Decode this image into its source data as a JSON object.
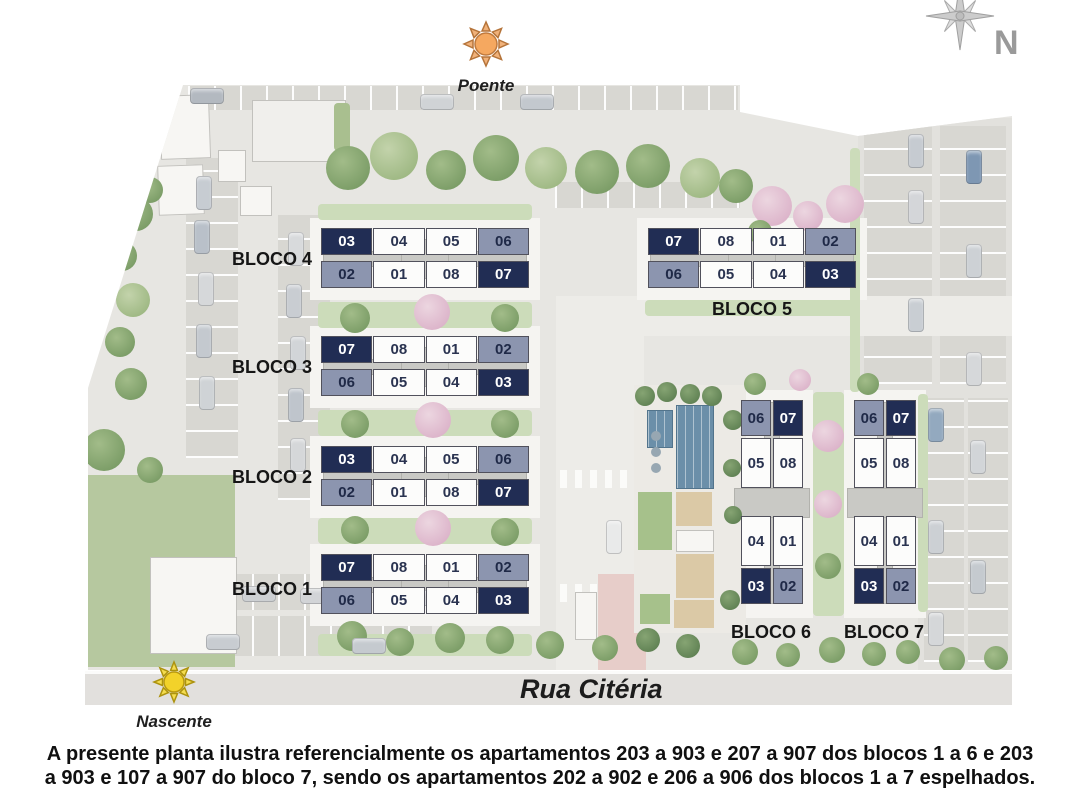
{
  "legend": {
    "poente": "Poente",
    "nascente": "Nascente",
    "compass_n": "N"
  },
  "street": {
    "name": "Rua Citéria"
  },
  "footnote": {
    "line1": "A presente planta ilustra referencialmente os apartamentos 203 a 903 e 207 a 907 dos blocos 1 a 6 e 203",
    "line2": "a 903 e 107 a 907 do bloco 7, sendo os apartamentos 202 a 902 e 206 a 906 dos blocos 1 a 7 espelhados."
  },
  "colors": {
    "unit_dark": "#212d54",
    "unit_gray": "#8c95af",
    "unit_white": "#fcfcfb",
    "pool_blue": "#6b8fa9",
    "sun_poente": "#f5a860",
    "sun_nascente": "#f2d22a"
  },
  "blocks": [
    {
      "name": "BLOCO 4",
      "orientation": "horizontal",
      "rows": [
        [
          {
            "n": "03",
            "tone": "dark"
          },
          {
            "n": "04",
            "tone": "white"
          },
          {
            "n": "05",
            "tone": "white"
          },
          {
            "n": "06",
            "tone": "gray"
          }
        ],
        [
          {
            "n": "02",
            "tone": "gray"
          },
          {
            "n": "01",
            "tone": "white"
          },
          {
            "n": "08",
            "tone": "white"
          },
          {
            "n": "07",
            "tone": "dark"
          }
        ]
      ]
    },
    {
      "name": "BLOCO 3",
      "orientation": "horizontal",
      "rows": [
        [
          {
            "n": "07",
            "tone": "dark"
          },
          {
            "n": "08",
            "tone": "white"
          },
          {
            "n": "01",
            "tone": "white"
          },
          {
            "n": "02",
            "tone": "gray"
          }
        ],
        [
          {
            "n": "06",
            "tone": "gray"
          },
          {
            "n": "05",
            "tone": "white"
          },
          {
            "n": "04",
            "tone": "white"
          },
          {
            "n": "03",
            "tone": "dark"
          }
        ]
      ]
    },
    {
      "name": "BLOCO 2",
      "orientation": "horizontal",
      "rows": [
        [
          {
            "n": "03",
            "tone": "dark"
          },
          {
            "n": "04",
            "tone": "white"
          },
          {
            "n": "05",
            "tone": "white"
          },
          {
            "n": "06",
            "tone": "gray"
          }
        ],
        [
          {
            "n": "02",
            "tone": "gray"
          },
          {
            "n": "01",
            "tone": "white"
          },
          {
            "n": "08",
            "tone": "white"
          },
          {
            "n": "07",
            "tone": "dark"
          }
        ]
      ]
    },
    {
      "name": "BLOCO 1",
      "orientation": "horizontal",
      "rows": [
        [
          {
            "n": "07",
            "tone": "dark"
          },
          {
            "n": "08",
            "tone": "white"
          },
          {
            "n": "01",
            "tone": "white"
          },
          {
            "n": "02",
            "tone": "gray"
          }
        ],
        [
          {
            "n": "06",
            "tone": "gray"
          },
          {
            "n": "05",
            "tone": "white"
          },
          {
            "n": "04",
            "tone": "white"
          },
          {
            "n": "03",
            "tone": "dark"
          }
        ]
      ]
    },
    {
      "name": "BLOCO 5",
      "orientation": "horizontal",
      "rows": [
        [
          {
            "n": "07",
            "tone": "dark"
          },
          {
            "n": "08",
            "tone": "white"
          },
          {
            "n": "01",
            "tone": "white"
          },
          {
            "n": "02",
            "tone": "gray"
          }
        ],
        [
          {
            "n": "06",
            "tone": "gray"
          },
          {
            "n": "05",
            "tone": "white"
          },
          {
            "n": "04",
            "tone": "white"
          },
          {
            "n": "03",
            "tone": "dark"
          }
        ]
      ]
    },
    {
      "name": "BLOCO 6",
      "orientation": "vertical",
      "rows": [
        [
          {
            "n": "06",
            "tone": "gray"
          },
          {
            "n": "07",
            "tone": "dark"
          }
        ],
        [
          {
            "n": "05",
            "tone": "white"
          },
          {
            "n": "08",
            "tone": "white"
          }
        ],
        [
          {
            "n": "04",
            "tone": "white"
          },
          {
            "n": "01",
            "tone": "white"
          }
        ],
        [
          {
            "n": "03",
            "tone": "dark"
          },
          {
            "n": "02",
            "tone": "gray"
          }
        ]
      ]
    },
    {
      "name": "BLOCO 7",
      "orientation": "vertical",
      "rows": [
        [
          {
            "n": "06",
            "tone": "gray"
          },
          {
            "n": "07",
            "tone": "dark"
          }
        ],
        [
          {
            "n": "05",
            "tone": "white"
          },
          {
            "n": "08",
            "tone": "white"
          }
        ],
        [
          {
            "n": "04",
            "tone": "white"
          },
          {
            "n": "01",
            "tone": "white"
          }
        ],
        [
          {
            "n": "03",
            "tone": "dark"
          },
          {
            "n": "02",
            "tone": "gray"
          }
        ]
      ]
    }
  ]
}
